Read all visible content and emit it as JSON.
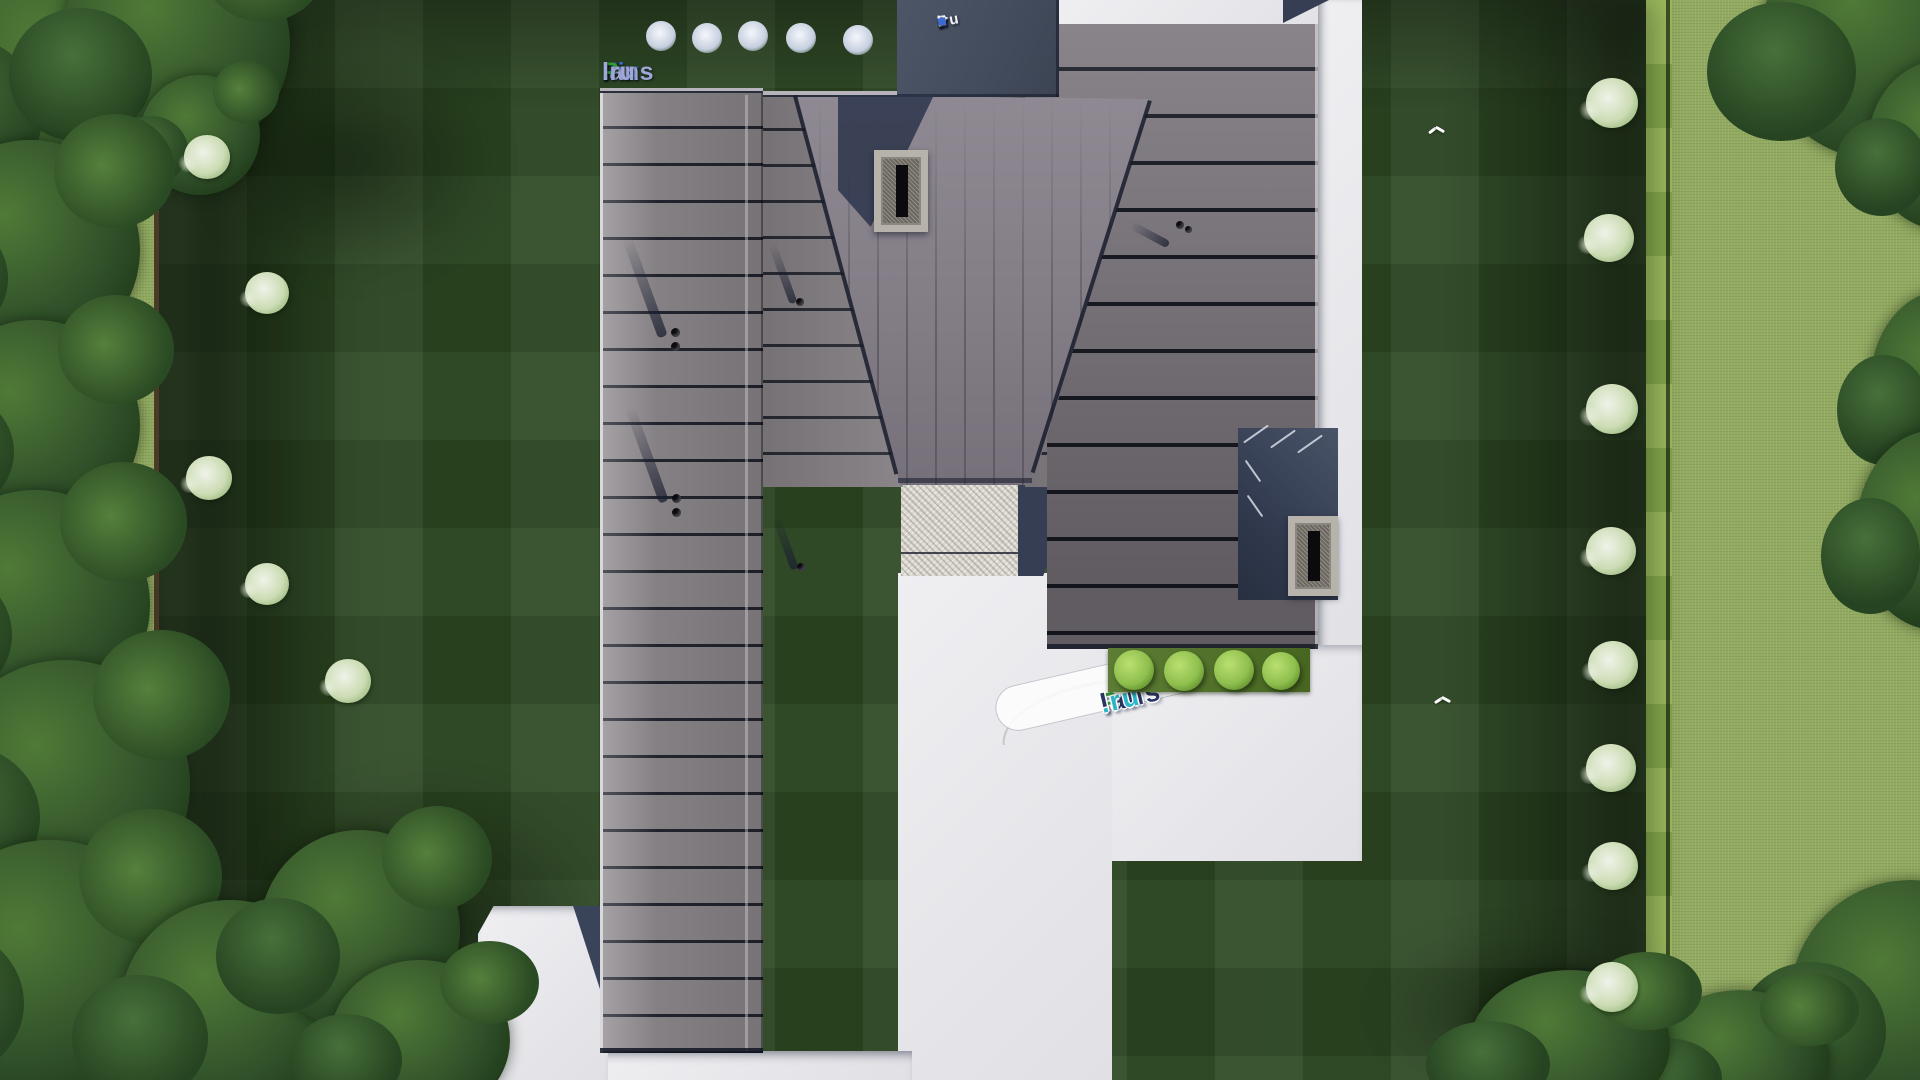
{
  "watermarks": {
    "top_left": {
      "fix": "Fix",
      "p": "P",
      "lans": "lans",
      "ru": ".ru"
    },
    "driveway": {
      "fix": "Fix",
      "p": "P",
      "lans": "lans",
      "ru": ".ru"
    },
    "flat_roof": {
      "f": "F",
      "i": "i",
      "x": "x",
      "p": "P",
      "l": "l",
      "a": "a",
      "n": "n",
      "s": "s",
      "ru": ".ru",
      "end_block": "■"
    }
  },
  "colors": {
    "brand_blue": "#3a6ad4",
    "brand_green": "#2f9e33",
    "brand_lavender": "#9fa8d8",
    "watermark_navy": "#2b3563",
    "roof_gray": "#8d888c",
    "roof_dark_gray": "#7c767d",
    "flat_roof_navy": "#454e60",
    "paving_white": "#e9e9ec",
    "lawn_dark_green": "#2c4722",
    "grass_light_green": "#92aa60"
  },
  "scene": {
    "type": "aerial-architectural-render",
    "counts": {
      "birds": 2,
      "chimneys": 2,
      "planter_bushes": 4,
      "right_bush_row": 8,
      "left_pale_bushes": 5,
      "flower_clusters": 5,
      "roof_vents": 5
    }
  }
}
